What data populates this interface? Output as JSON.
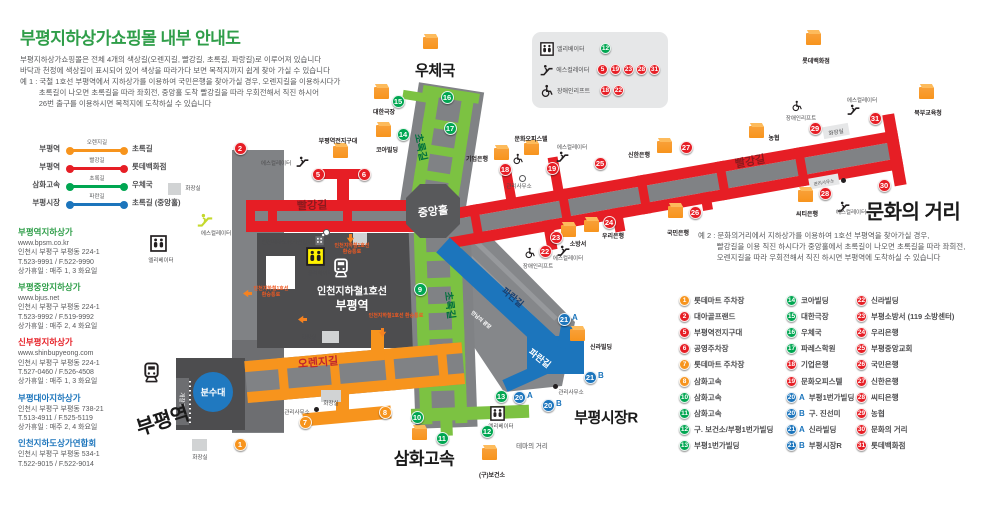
{
  "title": "부평지하상가쇼핑몰 내부 안내도",
  "description_lines": [
    "부평지하상가쇼핑몰은 전체 4개의 색상길(오렌지길, 빨강길, 초록길, 파랑길)로 이루어져 있습니다",
    "바닥과 천정에 색상길이 표시되어 있어 색상을 따라가다 보면 목적지까지 쉽게 찾아 가실 수 있습니다",
    "예 1 : 국철 1호선 부평역에서 지하상가를 이용하여 국민은행을 찾아가실 경우, 오렌지길을 이용하시다가",
    "         초록길이 나오면 초록길을 따라 좌회전, 중앙홀 도착 빨강길을 따라 우회전해서 직진 하시어",
    "         26번 출구를 이용하시면 목적지에 도착하실 수 있습니다"
  ],
  "example2_lines": [
    "예 2 : 문화의거리에서 지하상가를 이용하여 1호선 부평역을 찾아가실 경우,",
    "         빨강길을 이용 직진 하시다가 중앙홀에서 초록길이 나오면 초록길을 따라 좌회전,",
    "         오렌지길을 따라 우회전해서 직진 하시면 부평역에 도착하실 수 있습니다"
  ],
  "colors": {
    "red": "#E61E25",
    "orange": "#F7941D",
    "green": "#00A651",
    "green_road": "#7CC242",
    "blue": "#1C75BC"
  },
  "route_legend": [
    {
      "from": "부평역",
      "road": "오렌지길",
      "color": "#F7941D",
      "to": "초록길"
    },
    {
      "from": "부평역",
      "road": "빨강길",
      "color": "#E61E25",
      "to": "롯데백화점"
    },
    {
      "from": "삼화고속",
      "road": "초록길",
      "color": "#00A651",
      "to": "우체국"
    },
    {
      "from": "부평시장",
      "road": "파란길",
      "color": "#1C75BC",
      "to": "초록길 (중앙홀)"
    }
  ],
  "facility_legend": [
    {
      "icon": "elevator-icon",
      "label": "엘리베이터",
      "nums": [
        {
          "n": "12",
          "c": "green"
        }
      ]
    },
    {
      "icon": "escalator-icon",
      "label": "에스컬레이터",
      "nums": [
        {
          "n": "5",
          "c": "red"
        },
        {
          "n": "19",
          "c": "red"
        },
        {
          "n": "23",
          "c": "red"
        },
        {
          "n": "28",
          "c": "red"
        },
        {
          "n": "31",
          "c": "red"
        }
      ]
    },
    {
      "icon": "wheelchair-icon",
      "label": "장애인리프트",
      "nums": [
        {
          "n": "18",
          "c": "red"
        },
        {
          "n": "22",
          "c": "red"
        }
      ]
    }
  ],
  "contacts": [
    {
      "name": "부평역지하상가",
      "color": "#2F9E49",
      "lines": [
        "www.bpsm.co.kr",
        "인천시 부평구 부평동 224-1",
        "T.523-9991 / F.522-9990",
        "상가휴일 : 매주 1, 3 화요일"
      ]
    },
    {
      "name": "부평중앙지하상가",
      "color": "#2F9E49",
      "lines": [
        "www.bjus.net",
        "인천시 부평구 부평동 224-1",
        "T.523-9992 / F.519-9992",
        "상가휴일 : 매주 2, 4 화요일"
      ]
    },
    {
      "name": "신부평지하상가",
      "color": "#E61E25",
      "lines": [
        "www.shinbupyeong.com",
        "인천시 부평구 부평동 224-1",
        "T.527-0460 / F.526-4508",
        "상가휴일 : 매주 1, 3 화요일"
      ]
    },
    {
      "name": "부평대아지하상가",
      "color": "#1C75BC",
      "lines": [
        "인천시 부평구 부평동 738-21",
        "T.513-4911 / F.525-5119",
        "상가휴일 : 매주 2, 4 화요일"
      ]
    },
    {
      "name": "인천지하도상가연합회",
      "color": "#1C75BC",
      "lines": [
        "인천시 부평구 부평동 534-1",
        "T.522-9015 / F.522-9014"
      ]
    }
  ],
  "directory": {
    "columns": [
      {
        "x": 679,
        "entries": [
          {
            "n": "1",
            "c": "orange",
            "t": "롯데마트 주차장"
          },
          {
            "n": "2",
            "c": "red",
            "t": "대아골프랜드"
          },
          {
            "n": "5",
            "c": "red",
            "t": "부평역전지구대"
          },
          {
            "n": "6",
            "c": "red",
            "t": "공영주차장"
          },
          {
            "n": "7",
            "c": "orange",
            "t": "롯데마트 주차장"
          },
          {
            "n": "8",
            "c": "orange",
            "t": "삼화고속"
          },
          {
            "n": "10",
            "c": "green",
            "t": "삼화고속"
          },
          {
            "n": "11",
            "c": "green",
            "t": "삼화고속"
          },
          {
            "n": "12",
            "c": "green",
            "t": "구. 보건소/부평1번가빌딩"
          },
          {
            "n": "13",
            "c": "green",
            "t": "부평1번가빌딩"
          }
        ]
      },
      {
        "x": 786,
        "entries": [
          {
            "n": "14",
            "c": "green",
            "t": "코아빌딩"
          },
          {
            "n": "15",
            "c": "green",
            "t": "대한극장"
          },
          {
            "n": "16",
            "c": "green",
            "t": "우체국"
          },
          {
            "n": "17",
            "c": "green",
            "t": "파레스학원"
          },
          {
            "n": "18",
            "c": "red",
            "t": "기업은행"
          },
          {
            "n": "19",
            "c": "red",
            "t": "문화오피스텔"
          },
          {
            "n": "20",
            "s": "A",
            "c": "blue",
            "t": "부평1번가빌딩"
          },
          {
            "n": "20",
            "s": "B",
            "c": "blue",
            "t": "구. 진선미"
          },
          {
            "n": "21",
            "s": "A",
            "c": "blue",
            "t": "신라빌딩"
          },
          {
            "n": "21",
            "s": "B",
            "c": "blue",
            "t": "부평시장R"
          }
        ]
      },
      {
        "x": 856,
        "entries": [
          {
            "n": "22",
            "c": "red",
            "t": "신라빌딩"
          },
          {
            "n": "23",
            "c": "red",
            "t": "부평소방서 (119 소방센터)"
          },
          {
            "n": "24",
            "c": "red",
            "t": "우리은행"
          },
          {
            "n": "25",
            "c": "red",
            "t": "부평중앙교회"
          },
          {
            "n": "26",
            "c": "red",
            "t": "국민은행"
          },
          {
            "n": "27",
            "c": "red",
            "t": "신한은행"
          },
          {
            "n": "28",
            "c": "red",
            "t": "씨티은행"
          },
          {
            "n": "29",
            "c": "red",
            "t": "농협"
          },
          {
            "n": "30",
            "c": "red",
            "t": "문화의 거리"
          },
          {
            "n": "31",
            "c": "red",
            "t": "롯데백화점"
          }
        ]
      }
    ]
  },
  "map": {
    "exits": [
      {
        "n": "1",
        "c": "orange",
        "x": 240,
        "y": 444
      },
      {
        "n": "2",
        "c": "red",
        "x": 240,
        "y": 148
      },
      {
        "n": "5",
        "c": "red",
        "x": 318,
        "y": 174
      },
      {
        "n": "6",
        "c": "red",
        "x": 364,
        "y": 174
      },
      {
        "n": "7",
        "c": "orange",
        "x": 305,
        "y": 422
      },
      {
        "n": "8",
        "c": "orange",
        "x": 385,
        "y": 412
      },
      {
        "n": "9",
        "c": "green",
        "x": 420,
        "y": 289
      },
      {
        "n": "10",
        "c": "green",
        "x": 417,
        "y": 417
      },
      {
        "n": "11",
        "c": "green",
        "x": 442,
        "y": 438
      },
      {
        "n": "12",
        "c": "green",
        "x": 487,
        "y": 431
      },
      {
        "n": "13",
        "c": "green",
        "x": 501,
        "y": 396
      },
      {
        "n": "14",
        "c": "green",
        "x": 403,
        "y": 134
      },
      {
        "n": "15",
        "c": "green",
        "x": 398,
        "y": 101
      },
      {
        "n": "16",
        "c": "green",
        "x": 447,
        "y": 97
      },
      {
        "n": "17",
        "c": "green",
        "x": 450,
        "y": 128
      },
      {
        "n": "18",
        "c": "red",
        "x": 505,
        "y": 169
      },
      {
        "n": "19",
        "c": "red",
        "x": 552,
        "y": 168
      },
      {
        "n": "20",
        "s": "A",
        "c": "blue",
        "x": 519,
        "y": 397
      },
      {
        "n": "20",
        "s": "B",
        "c": "blue",
        "x": 548,
        "y": 405
      },
      {
        "n": "21",
        "s": "A",
        "c": "blue",
        "x": 564,
        "y": 319
      },
      {
        "n": "21",
        "s": "B",
        "c": "blue",
        "x": 590,
        "y": 377
      },
      {
        "n": "22",
        "c": "red",
        "x": 545,
        "y": 251
      },
      {
        "n": "23",
        "c": "red",
        "x": 556,
        "y": 237
      },
      {
        "n": "24",
        "c": "red",
        "x": 609,
        "y": 222
      },
      {
        "n": "25",
        "c": "red",
        "x": 600,
        "y": 163
      },
      {
        "n": "26",
        "c": "red",
        "x": 695,
        "y": 212
      },
      {
        "n": "27",
        "c": "red",
        "x": 686,
        "y": 147
      },
      {
        "n": "28",
        "c": "red",
        "x": 825,
        "y": 193
      },
      {
        "n": "29",
        "c": "red",
        "x": 815,
        "y": 128
      },
      {
        "n": "30",
        "c": "red",
        "x": 884,
        "y": 185
      },
      {
        "n": "31",
        "c": "red",
        "x": 875,
        "y": 118
      }
    ],
    "buildings": [
      {
        "t": "롯데백화점",
        "bx": 806,
        "by": 33,
        "lx": 816,
        "ly": 60
      },
      {
        "t": "북부교육청",
        "bx": 919,
        "by": 87,
        "lx": 928,
        "ly": 112
      },
      {
        "t": "대한극장",
        "bx": 374,
        "by": 87,
        "lx": 384,
        "ly": 111
      },
      {
        "t": "코아빌딩",
        "bx": 376,
        "by": 125,
        "lx": 387,
        "ly": 149
      },
      {
        "t": "부평역전지구대",
        "bx": 333,
        "by": 146,
        "lx": 338,
        "ly": 140
      },
      {
        "t": "기업은행",
        "bx": 494,
        "by": 148,
        "lx": 477,
        "ly": 158
      },
      {
        "t": "문화오피스텔",
        "bx": 524,
        "by": 143,
        "lx": 531,
        "ly": 138
      },
      {
        "t": "신한은행",
        "bx": 657,
        "by": 141,
        "lx": 639,
        "ly": 154
      },
      {
        "t": "농협",
        "bx": 749,
        "by": 126,
        "lx": 774,
        "ly": 137
      },
      {
        "t": "소방서",
        "bx": 561,
        "by": 225,
        "lx": 578,
        "ly": 243
      },
      {
        "t": "우리은행",
        "bx": 584,
        "by": 220,
        "lx": 613,
        "ly": 235
      },
      {
        "t": "국민은행",
        "bx": 668,
        "by": 206,
        "lx": 678,
        "ly": 232
      },
      {
        "t": "씨티은행",
        "bx": 798,
        "by": 190,
        "lx": 807,
        "ly": 213
      },
      {
        "t": "신라빌딩",
        "bx": 570,
        "by": 329,
        "lx": 601,
        "ly": 346
      },
      {
        "t": "(구)보건소",
        "bx": 482,
        "by": 448,
        "lx": 492,
        "ly": 474
      },
      {
        "t": "",
        "bx": 412,
        "by": 428,
        "lx": 0,
        "ly": 0
      },
      {
        "t": "",
        "bx": 423,
        "by": 37,
        "lx": 0,
        "ly": 0
      }
    ],
    "big_labels": [
      {
        "t": "우체국",
        "x": 435,
        "y": 70,
        "s": 15
      },
      {
        "t": "문화의 거리",
        "x": 913,
        "y": 210,
        "s": 20
      },
      {
        "t": "부평시장R",
        "x": 606,
        "y": 417,
        "s": 15
      },
      {
        "t": "삼화고속",
        "x": 424,
        "y": 457,
        "s": 17
      },
      {
        "t": "부평역",
        "x": 162,
        "y": 419,
        "s": 20,
        "r": -18
      }
    ],
    "road_labels": [
      {
        "t": "빨강길",
        "x": 312,
        "y": 205,
        "r": -2,
        "c": "#8B1A1E",
        "s": 11
      },
      {
        "t": "빨강길",
        "x": 750,
        "y": 161,
        "r": -10,
        "c": "#8B1A1E",
        "s": 11
      },
      {
        "t": "오렌지길",
        "x": 318,
        "y": 362,
        "r": -5,
        "c": "#C1272D",
        "s": 11
      },
      {
        "t": "초록길",
        "x": 422,
        "y": 147,
        "r": 78,
        "c": "#00703C",
        "s": 10
      },
      {
        "t": "초록길",
        "x": 451,
        "y": 305,
        "r": 83,
        "c": "#00703C",
        "s": 10
      },
      {
        "t": "파란길",
        "x": 513,
        "y": 297,
        "r": 40,
        "c": "#1B3F6E",
        "s": 9
      },
      {
        "t": "파란길",
        "x": 540,
        "y": 358,
        "r": 38,
        "c": "#FFFFFF",
        "s": 9
      },
      {
        "t": "중앙홀",
        "x": 433,
        "y": 211,
        "r": -6,
        "c": "#FFFFFF",
        "s": 11
      },
      {
        "t": "만남의 광장",
        "x": 481,
        "y": 320,
        "r": 40,
        "c": "#FFFFFF",
        "s": 5
      }
    ],
    "transfer_labels": [
      {
        "l1": "인천지하철1호선",
        "l2": "환승통로",
        "x": 352,
        "y": 243
      },
      {
        "l1": "인천지하철1호선",
        "l2": "환승통로",
        "x": 271,
        "y": 286
      },
      {
        "l1": "인천지하철1호선 환승통로",
        "l2": "",
        "x": 396,
        "y": 313
      }
    ],
    "station": {
      "line": "인천지하철1호선",
      "name": "부평역"
    },
    "fountain": "분수대",
    "small_labels": [
      {
        "t": "화장실",
        "x": 193,
        "y": 188
      },
      {
        "t": "화장실",
        "x": 309,
        "y": 337
      },
      {
        "t": "화장실",
        "x": 331,
        "y": 403
      },
      {
        "t": "화장실",
        "x": 200,
        "y": 457
      },
      {
        "t": "화장실",
        "x": 836,
        "y": 132,
        "r": -10
      },
      {
        "t": "관리사무소",
        "x": 519,
        "y": 186
      },
      {
        "t": "관리사무소",
        "x": 297,
        "y": 412
      },
      {
        "t": "관리사무소",
        "x": 571,
        "y": 392
      },
      {
        "t": "관리사무소",
        "x": 824,
        "y": 183,
        "r": -10,
        "s": 4.5
      },
      {
        "t": "테마의 거리",
        "x": 532,
        "y": 445,
        "s": 6.5
      },
      {
        "t": "인천지하도상가연합회",
        "x": 287,
        "y": 242
      },
      {
        "t": "에스컬레이터",
        "x": 276,
        "y": 163
      },
      {
        "t": "에스컬레이터",
        "x": 216,
        "y": 233
      },
      {
        "t": "에스컬레이터",
        "x": 572,
        "y": 147
      },
      {
        "t": "에스컬레이터",
        "x": 568,
        "y": 258
      },
      {
        "t": "에스컬레이터",
        "x": 851,
        "y": 212
      },
      {
        "t": "에스컬레이터",
        "x": 862,
        "y": 100
      },
      {
        "t": "장애인리프트",
        "x": 801,
        "y": 118
      },
      {
        "t": "장애인리프트",
        "x": 538,
        "y": 266
      },
      {
        "t": "엘리베이터",
        "x": 161,
        "y": 260
      },
      {
        "t": "엘리베이터",
        "x": 320,
        "y": 273
      },
      {
        "t": "엘리베이터",
        "x": 501,
        "y": 426
      },
      {
        "t": "개찰구",
        "x": 182,
        "y": 400,
        "r": 90,
        "c": "#FFFFFF"
      }
    ],
    "icons": [
      {
        "k": "escalator-icon",
        "x": 296,
        "y": 155,
        "s": 13
      },
      {
        "k": "escalator-yellow-icon",
        "x": 197,
        "y": 212,
        "s": 16
      },
      {
        "k": "escalator-icon",
        "x": 556,
        "y": 150,
        "s": 13
      },
      {
        "k": "escalator-icon",
        "x": 557,
        "y": 244,
        "s": 13
      },
      {
        "k": "escalator-icon",
        "x": 837,
        "y": 200,
        "s": 13
      },
      {
        "k": "escalator-icon",
        "x": 847,
        "y": 103,
        "s": 13
      },
      {
        "k": "wheelchair-icon",
        "x": 512,
        "y": 153,
        "s": 12
      },
      {
        "k": "wheelchair-icon",
        "x": 524,
        "y": 247,
        "s": 12
      },
      {
        "k": "wheelchair-icon",
        "x": 791,
        "y": 100,
        "s": 12
      },
      {
        "k": "elevator-icon",
        "x": 150,
        "y": 235,
        "s": 17
      },
      {
        "k": "elevator-icon",
        "x": 490,
        "y": 406,
        "s": 15
      },
      {
        "k": "elevator-yellow-icon",
        "x": 306,
        "y": 247,
        "s": 19
      },
      {
        "k": "train-white-icon",
        "x": 331,
        "y": 258,
        "s": 20
      },
      {
        "k": "train-icon",
        "x": 141,
        "y": 362,
        "s": 21
      },
      {
        "k": "building-icon",
        "x": 313,
        "y": 233,
        "s": 13
      },
      {
        "k": "arrow-down-icon",
        "x": 346,
        "y": 234,
        "s": 9
      },
      {
        "k": "arrow-down-icon",
        "x": 378,
        "y": 328,
        "s": 9
      },
      {
        "k": "arrow-left-icon",
        "x": 243,
        "y": 289,
        "s": 9
      },
      {
        "k": "arrow-left-icon",
        "x": 298,
        "y": 315,
        "s": 9
      }
    ],
    "gray_boxes": [
      {
        "x": 168,
        "y": 183,
        "w": 13,
        "h": 12
      },
      {
        "x": 353,
        "y": 233,
        "w": 14,
        "h": 12
      },
      {
        "x": 322,
        "y": 331,
        "w": 17,
        "h": 12
      },
      {
        "x": 321,
        "y": 390,
        "w": 20,
        "h": 12
      },
      {
        "x": 192,
        "y": 439,
        "w": 15,
        "h": 12
      },
      {
        "x": 823,
        "y": 125,
        "w": 26,
        "h": 12,
        "r": -10,
        "f": "#E6E7E8"
      },
      {
        "x": 809,
        "y": 176,
        "w": 30,
        "h": 11,
        "r": -10,
        "f": "#E6E7E8"
      }
    ],
    "dots": [
      {
        "x": 325,
        "y": 231,
        "c": "#FFFFFF"
      },
      {
        "x": 521,
        "y": 177,
        "c": "#FFFFFF"
      },
      {
        "x": 316,
        "y": 409,
        "c": "#231F20"
      },
      {
        "x": 555,
        "y": 386,
        "c": "#231F20"
      },
      {
        "x": 843,
        "y": 180,
        "c": "#231F20"
      }
    ]
  }
}
